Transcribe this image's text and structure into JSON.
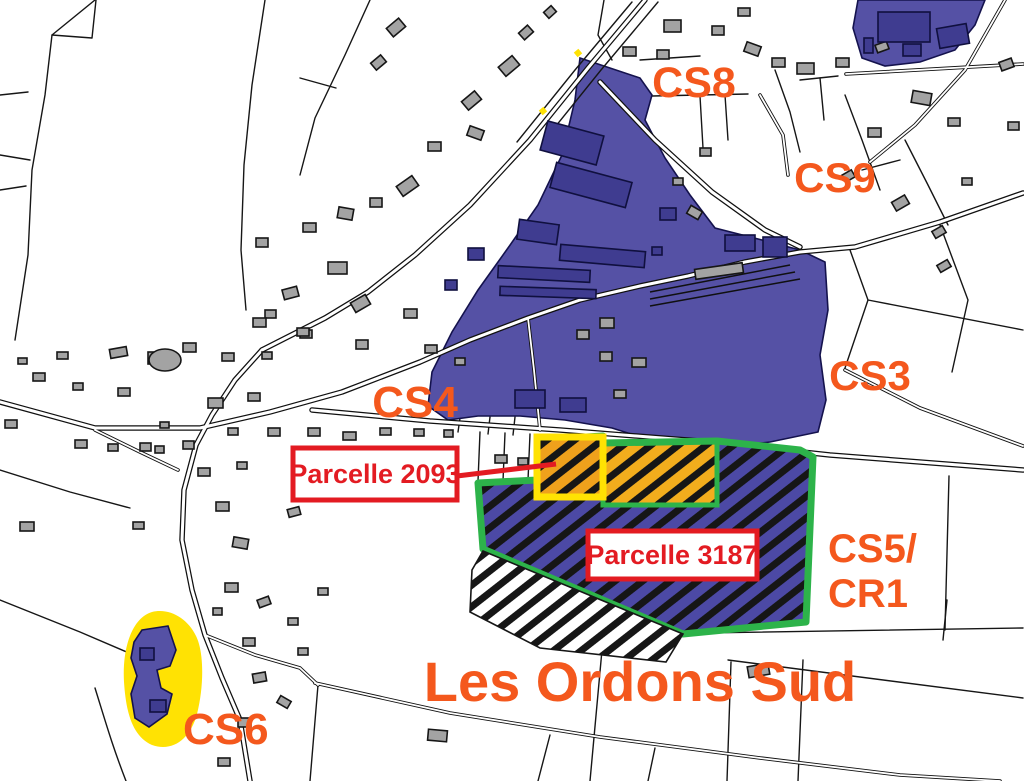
{
  "map": {
    "area_label": "Les Ordons Sud",
    "zone_labels": [
      {
        "id": "cs8",
        "text": "CS8"
      },
      {
        "id": "cs9",
        "text": "CS9"
      },
      {
        "id": "cs3",
        "text": "CS3"
      },
      {
        "id": "cs4",
        "text": "CS4"
      },
      {
        "id": "cs5",
        "text": "CS5/"
      },
      {
        "id": "cr1",
        "text": "CR1"
      },
      {
        "id": "cs6",
        "text": "CS6"
      }
    ],
    "callouts": [
      {
        "id": "parcelle-2093",
        "text": "Parcelle 2093"
      },
      {
        "id": "parcelle-3187",
        "text": "Parcelle 3187"
      }
    ],
    "colors": {
      "zone_blue": "#5551A5",
      "zone_blue_dark": "#4C49A5",
      "building_blue": "#3F3C90",
      "building_gray": "#A3A3A3",
      "label_orange": "#F4581D",
      "callout_red": "#E31B22",
      "outline_green": "#2DB34A",
      "highlight_yellow": "#FFE203",
      "hatch_orange": "#F2AD1D",
      "line_black": "#161616"
    }
  }
}
